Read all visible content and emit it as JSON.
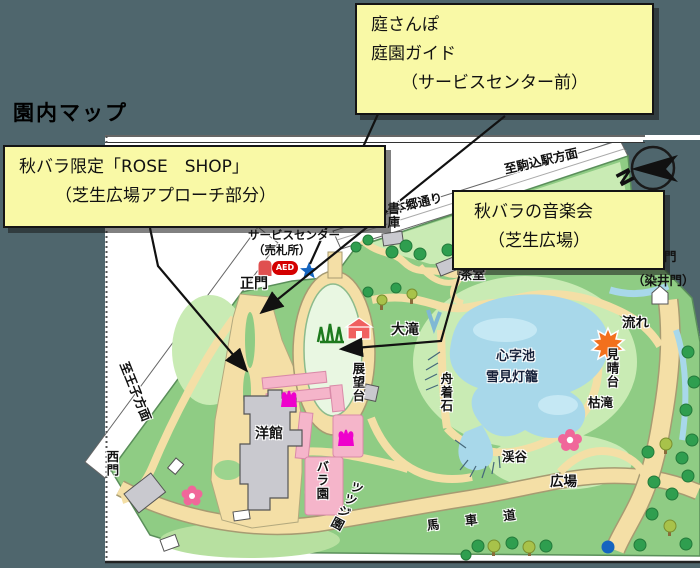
{
  "page_title": "園内マップ",
  "callouts": {
    "guide": {
      "line1": "庭さんぽ",
      "line2": "庭園ガイド",
      "line3": "（サービスセンター前）"
    },
    "rose_shop": {
      "line1": "秋バラ限定「ROSE　SHOP」",
      "line2": "（芝生広場アプローチ部分）"
    },
    "concert": {
      "line1": "秋バラの音楽会",
      "line2": "（芝生広場）"
    }
  },
  "map": {
    "labels": {
      "service_center": "サービスセンター",
      "ticket_office": "（売札所）",
      "main_gate": "正門",
      "aed": "AED",
      "hongo_street": "本郷通り",
      "to_komagome_station": "至駒込駅方面",
      "to_oji": "至王子方面",
      "book_storage": "書庫",
      "tea_house": "茶室",
      "somei_gate_partial": "門",
      "somei_gate": "（染井門）",
      "big_waterfall": "大滝",
      "shinji_pond": "心字池",
      "snow_lantern": "雪見灯籠",
      "boat_stone": "舟着石",
      "observation_deck": "展望台",
      "stream": "流れ",
      "lookout": "見晴台",
      "dry_waterfall": "枯滝",
      "gorge": "渓谷",
      "plaza": "広場",
      "carriage_road": "馬車道",
      "western_house": "洋館",
      "west_gate": "西門",
      "rose_garden": "バラ園",
      "azalea_garden": "ツツジ園",
      "compass_north": "N"
    },
    "colors": {
      "background_slate": "#4f666d",
      "park_green": "#8fcc84",
      "light_green": "#c9ebb4",
      "lawn_green": "#e9f7e2",
      "path_tan": "#f4dfa6",
      "pond_blue": "#a8d8ea",
      "rose_pink": "#f5b5ca",
      "tulip_magenta": "#ee00cc",
      "callout_yellow": "#f9f9a6",
      "marker_blue": "#1565c0",
      "aed_red": "#d40000"
    }
  }
}
